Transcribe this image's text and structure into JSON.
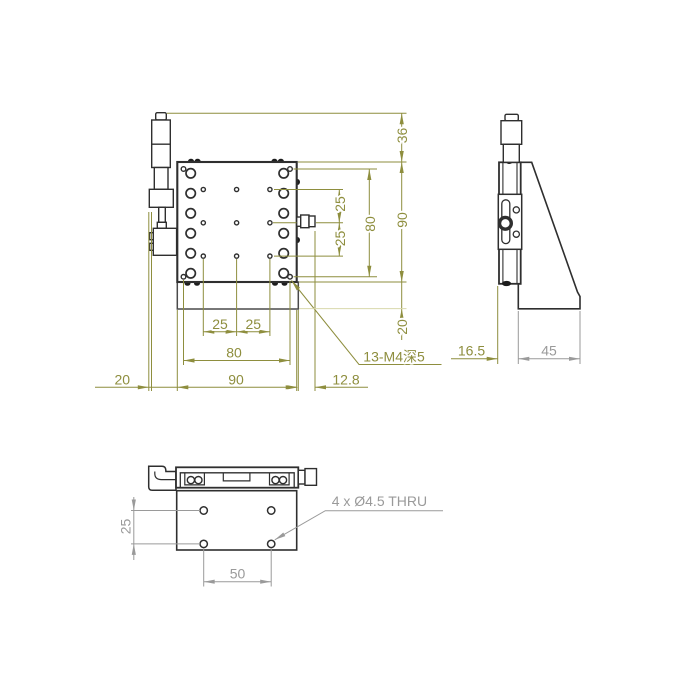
{
  "colors": {
    "line": "#2F2F2F",
    "line_soft": "#4A4A4A",
    "dim_olive": "#8E8E3E",
    "dim_olive_pale": "#D8D8AC",
    "dim_gray": "#9A9A9A",
    "background": "#FFFFFF"
  },
  "front_view": {
    "dims": {
      "height_knob_to_plate": "36",
      "height_overall": "90",
      "hole_span_v": "80",
      "hole_pitch_v_upper": "25",
      "hole_pitch_v_lower": "25",
      "base_height": "20",
      "hole_pitch_h_left": "25",
      "hole_pitch_h_right": "25",
      "hole_span_h": "80",
      "width_overall": "90",
      "knob_offset_left": "20",
      "shaft_extension": "12.8"
    },
    "note_threaded_holes": "13-M4深5"
  },
  "side_view": {
    "dims": {
      "plate_thickness": "16.5",
      "base_depth": "45"
    }
  },
  "bottom_view": {
    "dims": {
      "hole_pitch_v": "25",
      "hole_pitch_h": "50"
    },
    "note_through_holes": "4 x Ø4.5 THRU"
  }
}
